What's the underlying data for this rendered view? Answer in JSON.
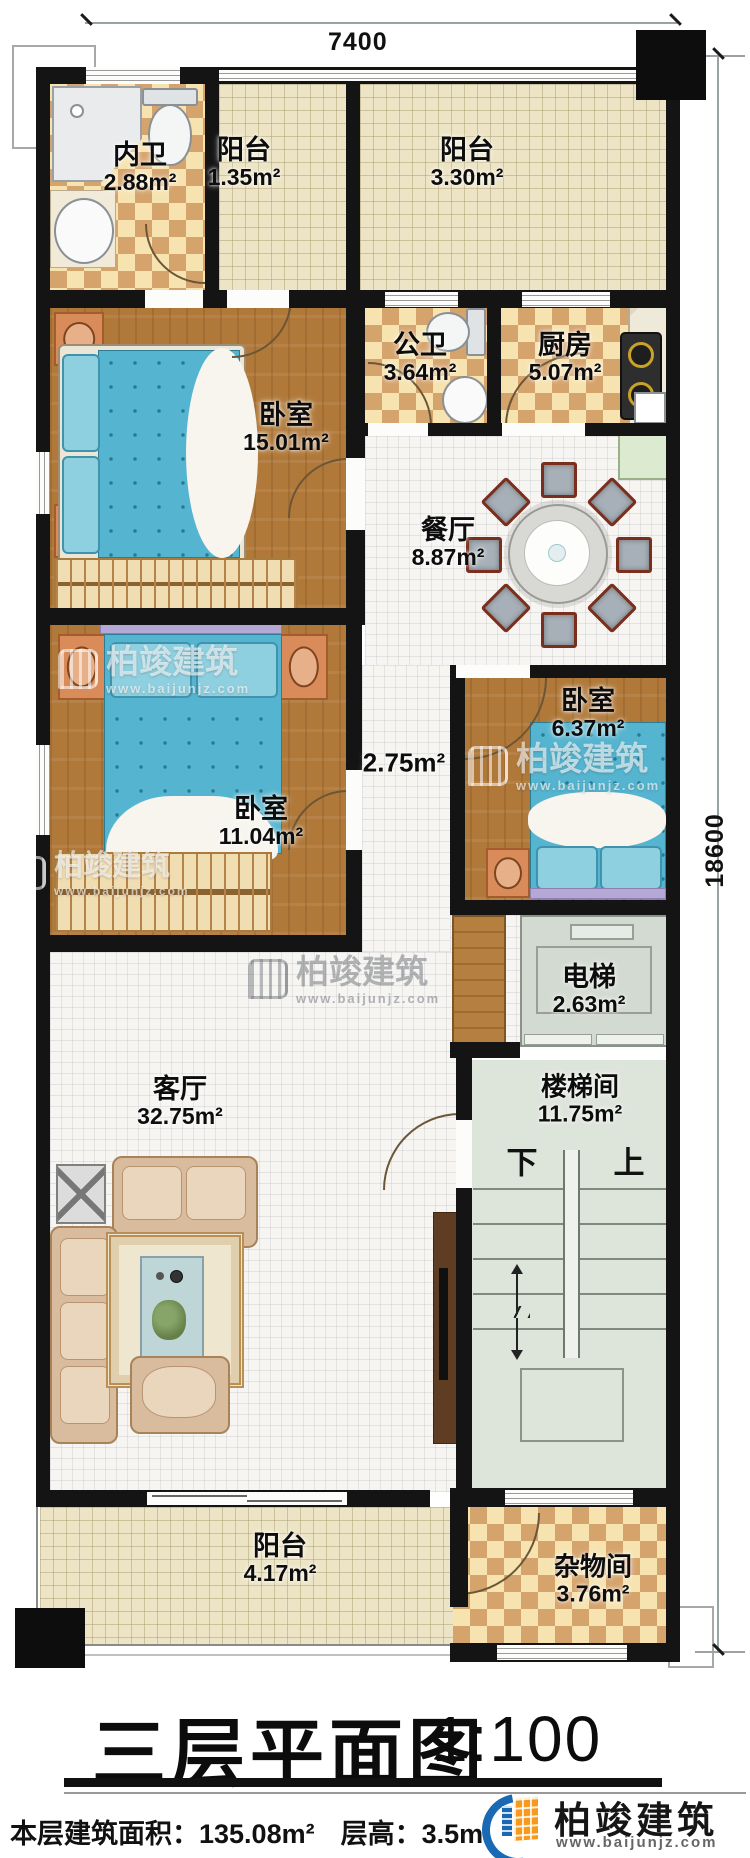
{
  "title": {
    "text": "三层平面图",
    "scale": "1:100"
  },
  "footer": {
    "area_label": "本层建筑面积：",
    "area_value": "135.08m²",
    "height_label": "层高：",
    "height_value": "3.5m"
  },
  "dims": {
    "width": "7400",
    "height": "18600"
  },
  "brand": {
    "name": "柏竣建筑",
    "url": "www.baijunjz.com"
  },
  "stairs": {
    "down": "下",
    "up": "上"
  },
  "rooms": [
    {
      "name": "内卫",
      "area": "2.88m²"
    },
    {
      "name": "阳台",
      "area": "1.35m²"
    },
    {
      "name": "阳台",
      "area": "3.30m²"
    },
    {
      "name": "卧室",
      "area": "15.01m²"
    },
    {
      "name": "公卫",
      "area": "3.64m²"
    },
    {
      "name": "厨房",
      "area": "5.07m²"
    },
    {
      "name": "餐厅",
      "area": "8.87m²"
    },
    {
      "name": "卧室",
      "area": "11.04m²"
    },
    {
      "name": "",
      "area": "2.75m²"
    },
    {
      "name": "卧室",
      "area": "6.37m²"
    },
    {
      "name": "电梯",
      "area": "2.63m²"
    },
    {
      "name": "客厅",
      "area": "32.75m²"
    },
    {
      "name": "楼梯间",
      "area": "11.75m²"
    },
    {
      "name": "阳台",
      "area": "4.17m²"
    },
    {
      "name": "杂物间",
      "area": "3.76m²"
    }
  ]
}
